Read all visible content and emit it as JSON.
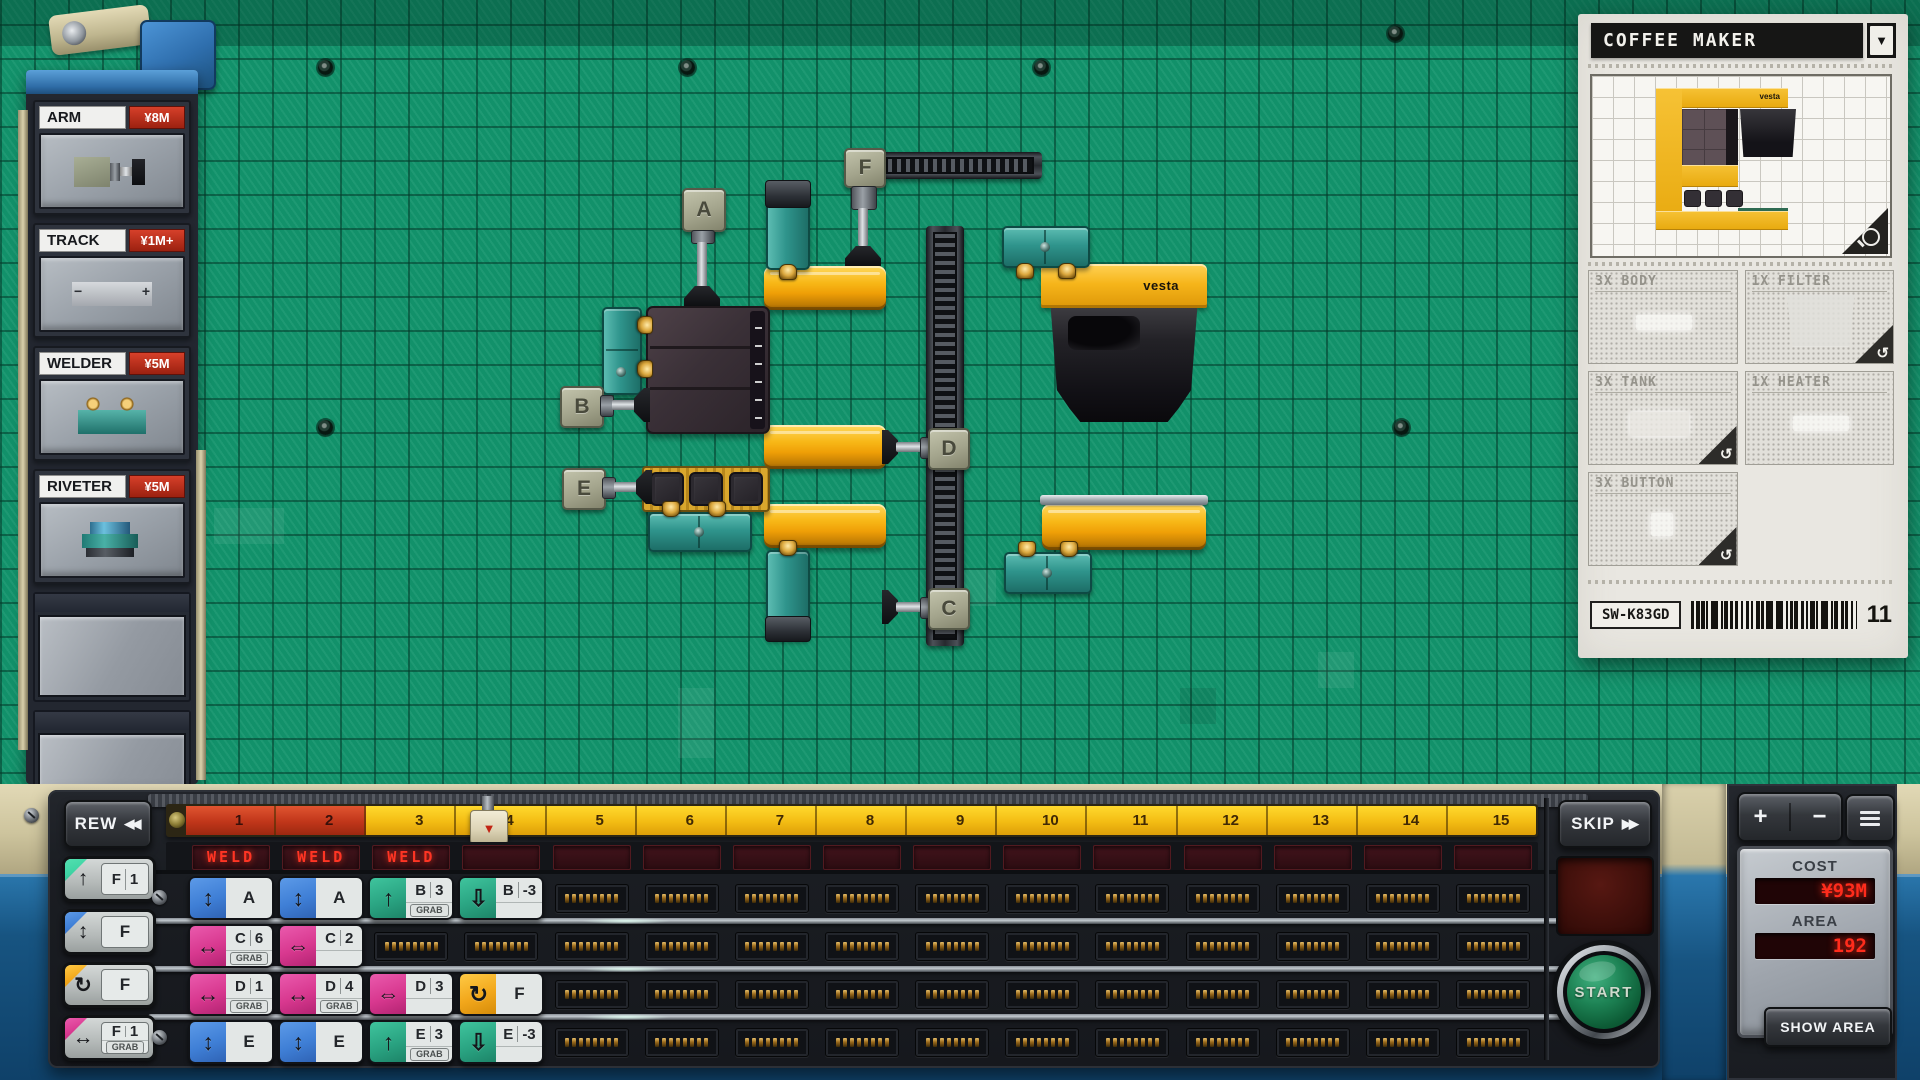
{
  "icon_glyphs": {
    "updown": "↕",
    "up": "↑",
    "down-outline": "⇩",
    "lr": "↔",
    "lr-outline": "⇔",
    "rotate": "↻",
    "rotate-ccw": "↺",
    "dropdown": "▼",
    "rew": "◀◀",
    "skip": "▶▶",
    "playhead": "▼"
  },
  "labels": {
    "grab": "GRAB"
  },
  "sidebar": {
    "items": [
      {
        "name": "ARM",
        "price": "¥8M",
        "thumb": "arm"
      },
      {
        "name": "TRACK",
        "price": "¥1M+",
        "thumb": "track"
      },
      {
        "name": "WELDER",
        "price": "¥5M",
        "thumb": "welder"
      },
      {
        "name": "RIVETER",
        "price": "¥5M",
        "thumb": "riveter"
      }
    ],
    "empty_slots": 2,
    "track_glyphs": [
      "−",
      "+"
    ]
  },
  "board": {
    "arms": [
      "A",
      "B",
      "C",
      "D",
      "E",
      "F"
    ],
    "brand": "vesta"
  },
  "product_panel": {
    "title": "COFFEE MAKER",
    "brand": "vesta",
    "sku": "SW-K83GD",
    "count": "11",
    "parts": [
      {
        "qty_label": "3X BODY",
        "rotatable": false,
        "shape": "bar"
      },
      {
        "qty_label": "1X FILTER",
        "rotatable": true,
        "shape": "tall"
      },
      {
        "qty_label": "3X TANK",
        "rotatable": true,
        "shape": "wide"
      },
      {
        "qty_label": "1X HEATER",
        "rotatable": false,
        "shape": "bar"
      },
      {
        "qty_label": "3X BUTTON",
        "rotatable": true,
        "shape": "dot"
      }
    ]
  },
  "transport": {
    "rew_label": "REW",
    "skip_label": "SKIP",
    "start_label": "START",
    "elapsed_segments": 2,
    "timeline_numbers": [
      "1",
      "2",
      "3",
      "4",
      "5",
      "6",
      "7",
      "8",
      "9",
      "10",
      "11",
      "12",
      "13",
      "14",
      "15"
    ],
    "phase_displays": [
      "WELD",
      "WELD",
      "WELD",
      "",
      "",
      "",
      "",
      "",
      "",
      "",
      "",
      "",
      "",
      "",
      ""
    ]
  },
  "palette": [
    {
      "icon": "up",
      "color": "teal",
      "key": "F",
      "value": "1"
    },
    {
      "icon": "updown",
      "color": "blue",
      "key": "F"
    },
    {
      "icon": "rotate",
      "color": "yellow",
      "key": "F"
    },
    {
      "icon": "lr",
      "color": "pink",
      "key": "F",
      "value": "1",
      "grab": true
    }
  ],
  "program": {
    "columns": 15,
    "rows": [
      {
        "cells": [
          {
            "icon": "updown",
            "color": "blue",
            "label": "A"
          },
          {
            "icon": "updown",
            "color": "blue",
            "label": "A"
          },
          {
            "icon": "up",
            "color": "green",
            "label": "B",
            "value": "3",
            "grab": true
          },
          {
            "icon": "down-outline",
            "color": "green",
            "label": "B",
            "value": "-3"
          }
        ]
      },
      {
        "cells": [
          {
            "icon": "lr",
            "color": "pink",
            "label": "C",
            "value": "6",
            "grab": true
          },
          {
            "icon": "lr-outline",
            "color": "pink",
            "label": "C",
            "value": "2"
          }
        ]
      },
      {
        "cells": [
          {
            "icon": "lr",
            "color": "pink",
            "label": "D",
            "value": "1",
            "grab": true
          },
          {
            "icon": "lr",
            "color": "pink",
            "label": "D",
            "value": "4",
            "grab": true
          },
          {
            "icon": "lr-outline",
            "color": "pink",
            "label": "D",
            "value": "3"
          },
          {
            "icon": "rotate",
            "color": "yellow",
            "label": "F"
          }
        ]
      },
      {
        "cells": [
          {
            "icon": "updown",
            "color": "blue",
            "label": "E"
          },
          {
            "icon": "updown",
            "color": "blue",
            "label": "E"
          },
          {
            "icon": "up",
            "color": "green",
            "label": "E",
            "value": "3",
            "grab": true
          },
          {
            "icon": "down-outline",
            "color": "green",
            "label": "E",
            "value": "-3"
          }
        ]
      }
    ]
  },
  "cost_panel": {
    "cost_label": "COST",
    "cost_value": "¥93M",
    "area_label": "AREA",
    "area_value": "192",
    "show_area_label": "SHOW AREA",
    "increase": "+",
    "decrease": "−"
  },
  "colors": {
    "board_green": "#12946c",
    "conveyor_yellow": "#f2ae10",
    "welder_teal": "#2f948c",
    "chip_blue": "#3f7fd6",
    "chip_green": "#2aa482",
    "chip_pink": "#d8388f",
    "chip_yellow": "#f2a71b",
    "led_red": "#ff2c1c",
    "price_red": "#bb2c18"
  }
}
